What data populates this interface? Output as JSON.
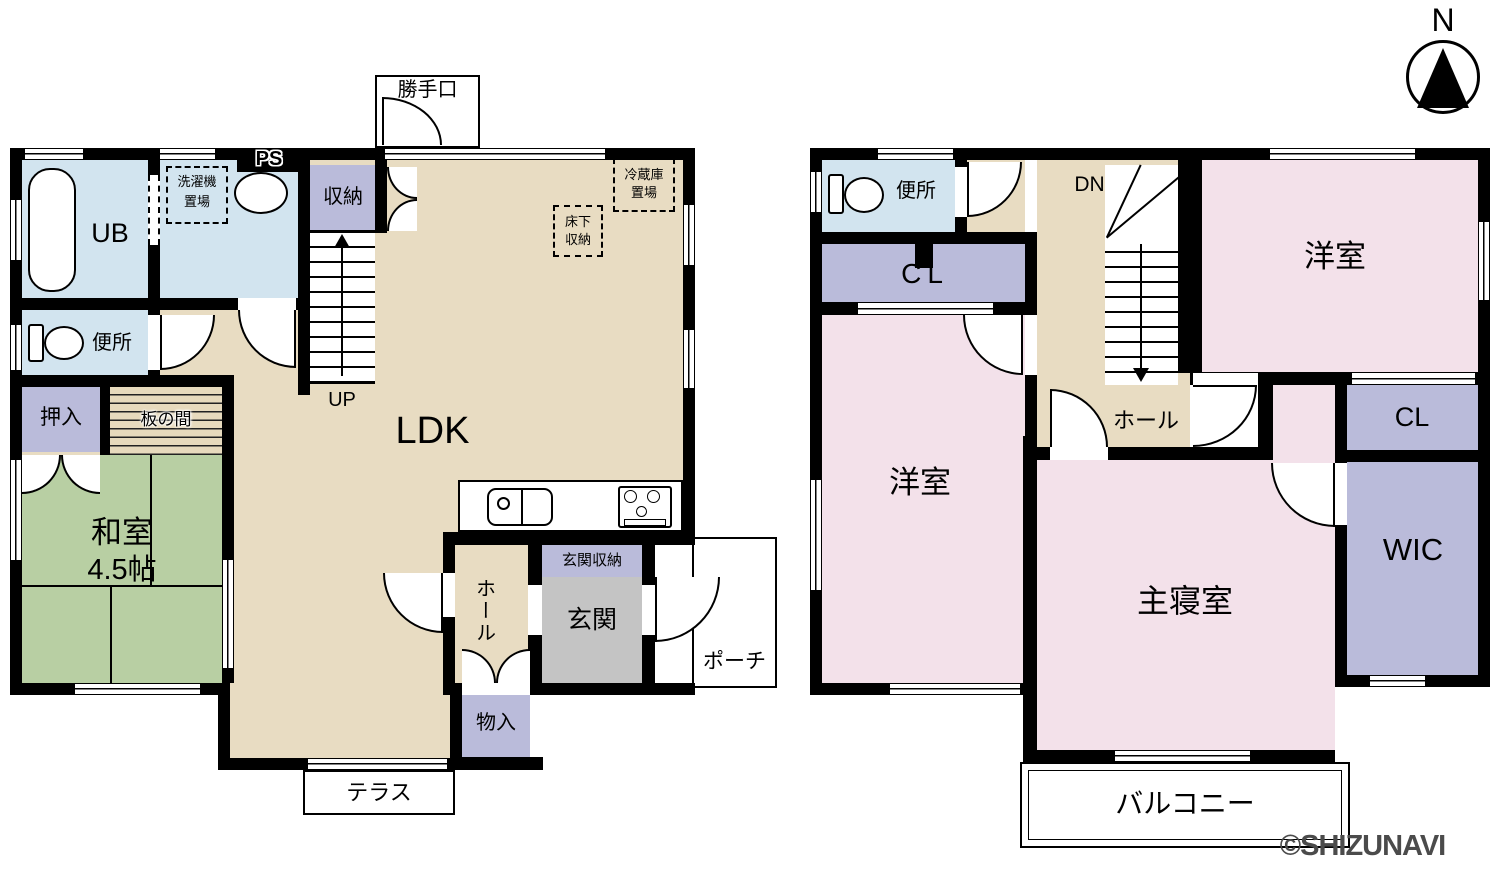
{
  "colors": {
    "wall": "#000000",
    "ldk_tan": "#e8dcc2",
    "wet_blue": "#d2e4ef",
    "closet_purple": "#babbda",
    "tatami_green": "#b8cfa3",
    "bedroom_pink": "#f3e1ea",
    "genkan_gray": "#c4c4c4",
    "watermark_gray": "#4b4b4b"
  },
  "compass": {
    "north": "N"
  },
  "watermark": "©SHIZUNAVI",
  "floor1": {
    "katteguchi": "勝手口",
    "ps": "PS",
    "shuno": "収納",
    "laundry1": "洗濯機",
    "laundry2": "置場",
    "ub": "UB",
    "benjo": "便所",
    "oshiire": "押入",
    "itanoma": "板の間",
    "washitsu": "和室",
    "washitsu_size": "4.5帖",
    "ldk": "LDK",
    "up": "UP",
    "yukashita1": "床下",
    "yukashita2": "収納",
    "reizoko1": "冷蔵庫",
    "reizoko2": "置場",
    "hall": "ホール",
    "genkan_shuno": "玄関収納",
    "genkan": "玄関",
    "porch": "ポーチ",
    "monoire": "物入",
    "terrace": "テラス"
  },
  "floor2": {
    "benjo": "便所",
    "dn": "DN",
    "cl_left": "CL",
    "yoshitsu_left": "洋室",
    "yoshitsu_right": "洋室",
    "hall": "ホール",
    "cl_right": "CL",
    "wic": "WIC",
    "master": "主寝室",
    "balcony": "バルコニー"
  }
}
